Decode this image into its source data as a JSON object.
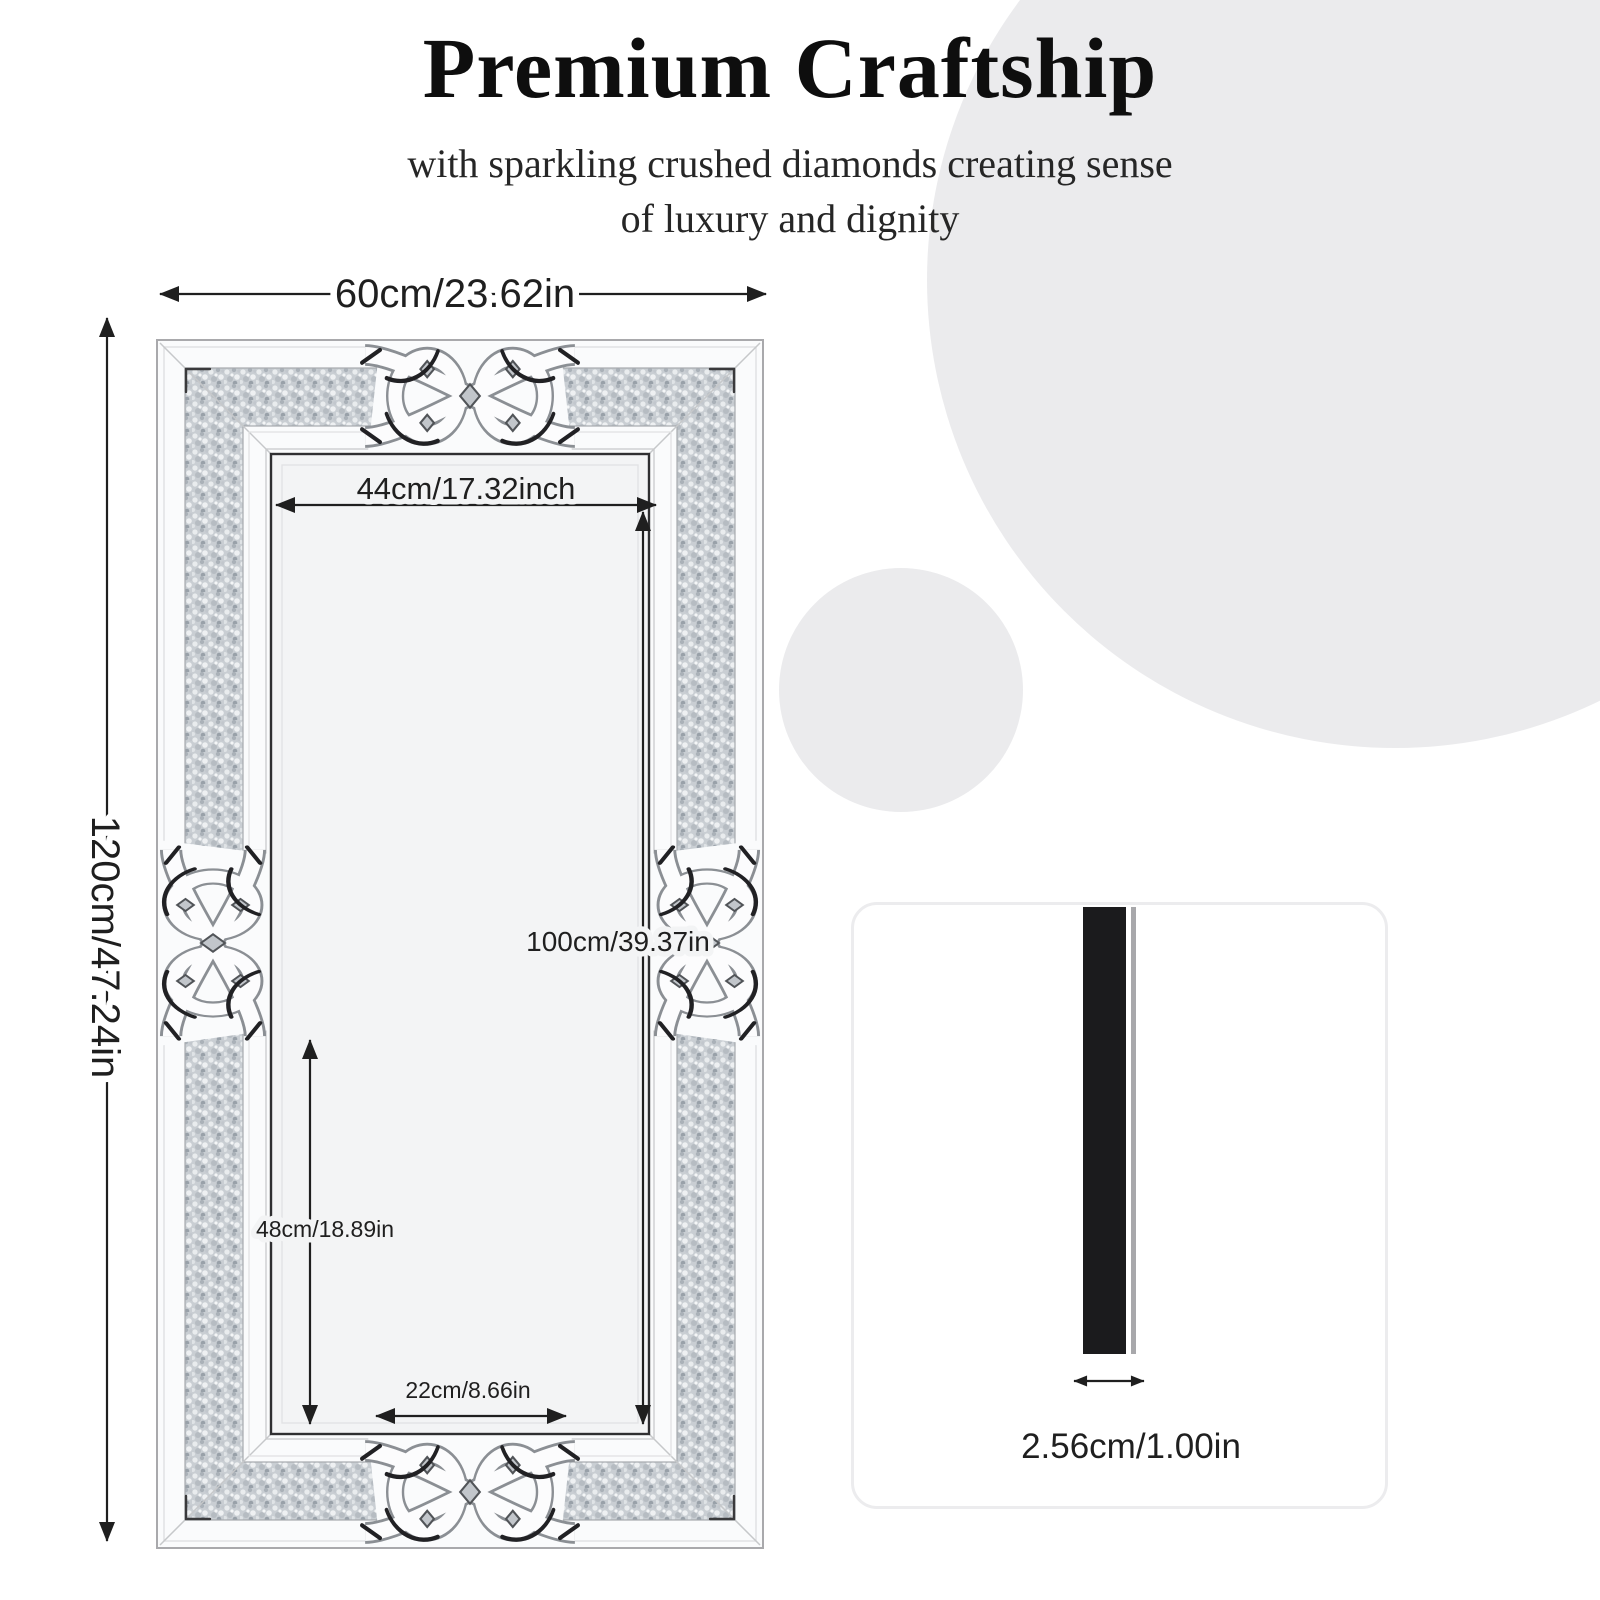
{
  "header": {
    "title": "Premium Craftship",
    "subtitle_line1": "with sparkling crushed diamonds creating sense",
    "subtitle_line2": "of luxury and dignity"
  },
  "mirror": {
    "outer_width_label": "60cm/23.62in",
    "outer_height_label": "120cm/47.24in",
    "inner_width_label": "44cm/17.32inch",
    "inner_height_label": "100cm/39.37in",
    "lower_height_label": "48cm/18.89in",
    "bottom_width_label": "22cm/8.66in"
  },
  "thickness_card": {
    "label": "2.56cm/1.00in"
  },
  "colors": {
    "ink": "#1f1f1f",
    "circle_bg": "#ebebed",
    "frame_fill": "#fafbfc",
    "face_fill": "#f3f4f5",
    "face_edge": "#2f2f31",
    "band_base": "#c9ced3",
    "bar_fill": "#1b1b1d",
    "edge_strip": "#a8a8ab",
    "card_border": "#ececee"
  }
}
